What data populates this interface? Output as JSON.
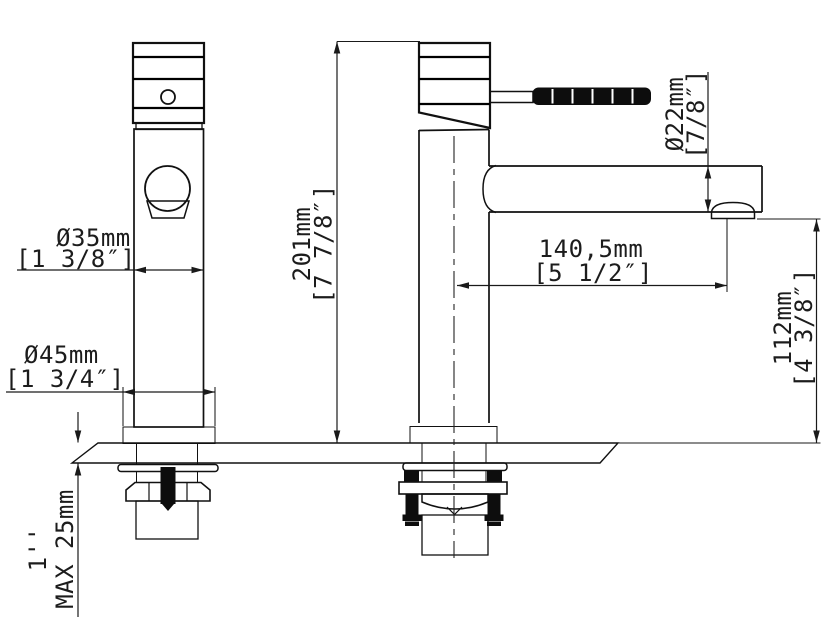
{
  "title": "Basin mixer faucet installation drawing",
  "dimensions": {
    "body_diameter": {
      "metric": "Ø35mm",
      "imperial": "[1 3/8″]"
    },
    "base_diameter": {
      "metric": "Ø45mm",
      "imperial": "[1 3/4″]"
    },
    "total_height": {
      "metric": "201mm",
      "imperial": "[7 7/8″]"
    },
    "spout_diameter": {
      "metric": "Ø22mm",
      "imperial": "[7/8″]"
    },
    "spout_reach": {
      "metric": "140,5mm",
      "imperial": "[5 1/2″]"
    },
    "outlet_height": {
      "metric": "112mm",
      "imperial": "[4 3/8″]"
    },
    "max_deck_thickness": {
      "imperial": "1''",
      "metric": "MAX 25mm"
    }
  },
  "colors": {
    "line": "#1a1a1a",
    "background": "#ffffff"
  }
}
